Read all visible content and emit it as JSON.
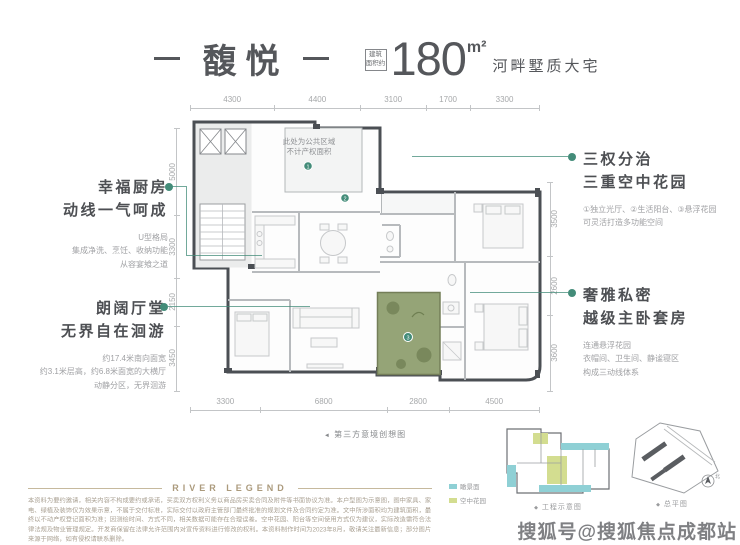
{
  "colors": {
    "ink": "#55575b",
    "accent_green": "#438c79",
    "text_gray": "#9d9ea1",
    "dim_line": "#c3c5c7",
    "brand_gold": "#ab9a7c",
    "disclaimer": "#aaa193",
    "teal": "#8fd0d5",
    "olive": "#d3dd90",
    "garden_fill": "#95a477",
    "watermark": "#6e6f73"
  },
  "header": {
    "title": "馥悦",
    "area_label_line1": "建筑",
    "area_label_line2": "面积约",
    "area_value": "180",
    "area_unit": "m²",
    "subtitle": "河畔墅质大宅"
  },
  "dimensions": {
    "top": [
      4300,
      4400,
      3100,
      1700,
      3300
    ],
    "bottom": [
      3300,
      6800,
      2800,
      4500
    ],
    "left": [
      5000,
      3300,
      2150,
      3450
    ],
    "right": [
      3500,
      2600,
      3600
    ]
  },
  "plan": {
    "note_line1": "此处为公共区域",
    "note_line2": "不计产权面积",
    "markers": [
      "1",
      "2",
      "3"
    ]
  },
  "annotations": {
    "left_top": {
      "title1": "幸福厨房",
      "title2": "动线一气呵成",
      "details": [
        "U型格局",
        "集成净洗、烹饪、收纳功能",
        "从容宴飨之道"
      ]
    },
    "left_bottom": {
      "title1": "朗阔厅堂",
      "title2": "无界自在洄游",
      "details": [
        "约17.4米南向面宽",
        "约3.1米层高，约6.8米面宽的大横厅",
        "动静分区，无界洄游"
      ]
    },
    "right_top": {
      "title1": "三权分治",
      "title2": "三重空中花园",
      "details": [
        "①独立光厅、②生活阳台、③悬浮花园",
        "可灵活打造多功能空间"
      ]
    },
    "right_bottom": {
      "title1": "奢雅私密",
      "title2": "越级主卧套房",
      "details": [
        "连通悬浮花园",
        "衣帽间、卫生间、静谧寝区",
        "构成三动线体系"
      ]
    }
  },
  "captions": {
    "center_marker": "◄",
    "center": "第三方意境创想图",
    "engineering_marker": "◆",
    "engineering": "工程示意图",
    "siteplan_marker": "◆",
    "siteplan": "总平图",
    "compass": "北"
  },
  "legend": [
    {
      "color": "#8fd0d5",
      "label": "瞰景面"
    },
    {
      "color": "#d3dd90",
      "label": "空中花园"
    }
  ],
  "footer": {
    "brand": "RIVER LEGEND",
    "disclaimer": "本资料为要约邀请，相关内容不构成要约或承诺，买卖双方权利义务以商品房买卖合同及附件等书面协议为准。本户型图为示意图，图中家具、家电、绿植及装饰仅为效果示意，不属于交付标准，实际交付以政府主管部门最终批准的规划文件及合同约定为准。文中所涉面积均为建筑面积，最终以不动产权登记面积为准；因测绘时间、方式不同，相关数据可能存在合理误差。空中花园、阳台等空间使用方式仅为建议，实际改造需符合法律法规及物业管理规定。开发商保留在法律允许范围内对宣传资料进行修改的权利。本资料制作时间为2023年8月，敬请关注最新信息；部分图片来源于网络，如有侵权请联系删除。"
  },
  "watermark": "搜狐号@搜狐焦点成都站"
}
